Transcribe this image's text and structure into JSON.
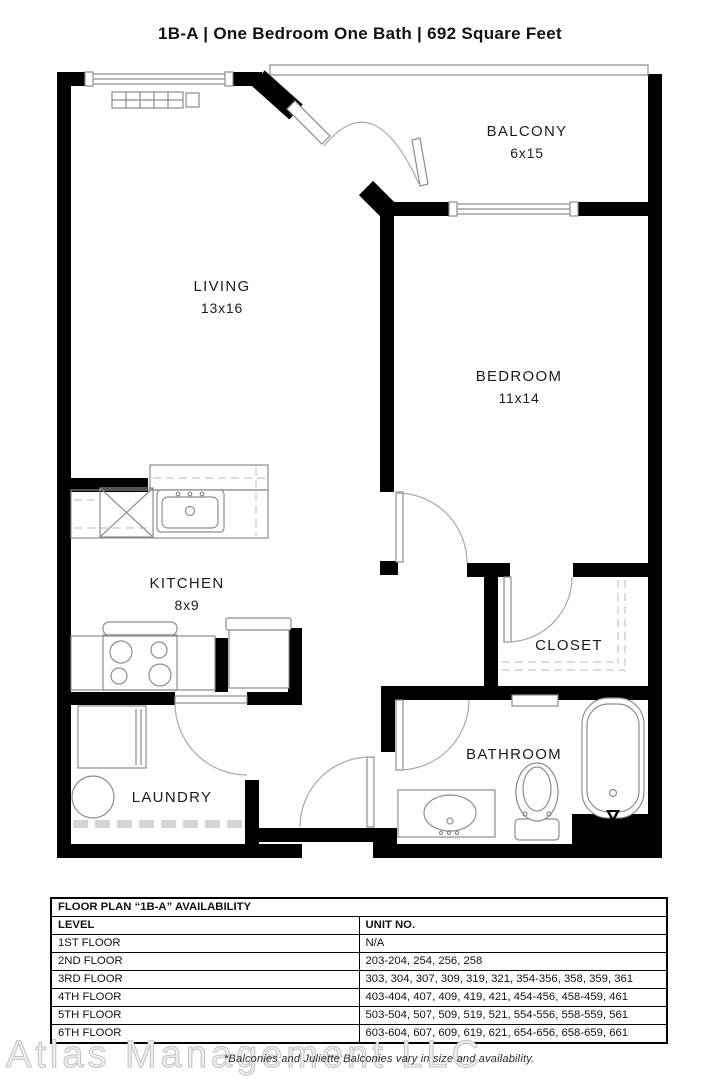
{
  "title": "1B-A | One Bedroom One Bath |  692 Square Feet",
  "rooms": {
    "balcony": {
      "name": "BALCONY",
      "dims": "6x15"
    },
    "living": {
      "name": "LIVING",
      "dims": "13x16"
    },
    "bedroom": {
      "name": "BEDROOM",
      "dims": "11x14"
    },
    "kitchen": {
      "name": "KITCHEN",
      "dims": "8x9"
    },
    "closet": {
      "name": "CLOSET"
    },
    "bathroom": {
      "name": "BATHROOM"
    },
    "laundry": {
      "name": "LAUNDRY"
    }
  },
  "availability": {
    "table_title": "FLOOR PLAN “1B-A” AVAILABILITY",
    "columns": [
      "LEVEL",
      "UNIT NO."
    ],
    "rows": [
      {
        "level": "1ST FLOOR",
        "units": "N/A"
      },
      {
        "level": "2ND FLOOR",
        "units": "203-204, 254, 256, 258"
      },
      {
        "level": "3RD FLOOR",
        "units": "303, 304, 307, 309, 319, 321, 354-356, 358, 359, 361"
      },
      {
        "level": "4TH FLOOR",
        "units": "403-404, 407, 409, 419, 421, 454-456, 458-459, 461"
      },
      {
        "level": "5TH FLOOR",
        "units": "503-504, 507, 509, 519, 521, 554-556, 558-559, 561"
      },
      {
        "level": "6TH FLOOR",
        "units": "603-604, 607, 609, 619, 621, 654-656, 658-659, 661"
      }
    ]
  },
  "footer": {
    "watermark": "Atlas Management LLC",
    "note": "*Balconies and Juliette Balconies vary in size and availability."
  },
  "colors": {
    "wall": "#000000",
    "fixture_line": "#8d8d8d",
    "door_arc": "#a8a8a8",
    "dashed": "#c6c6c6",
    "text": "#1c1c1c",
    "watermark": "#d4d4d4"
  }
}
